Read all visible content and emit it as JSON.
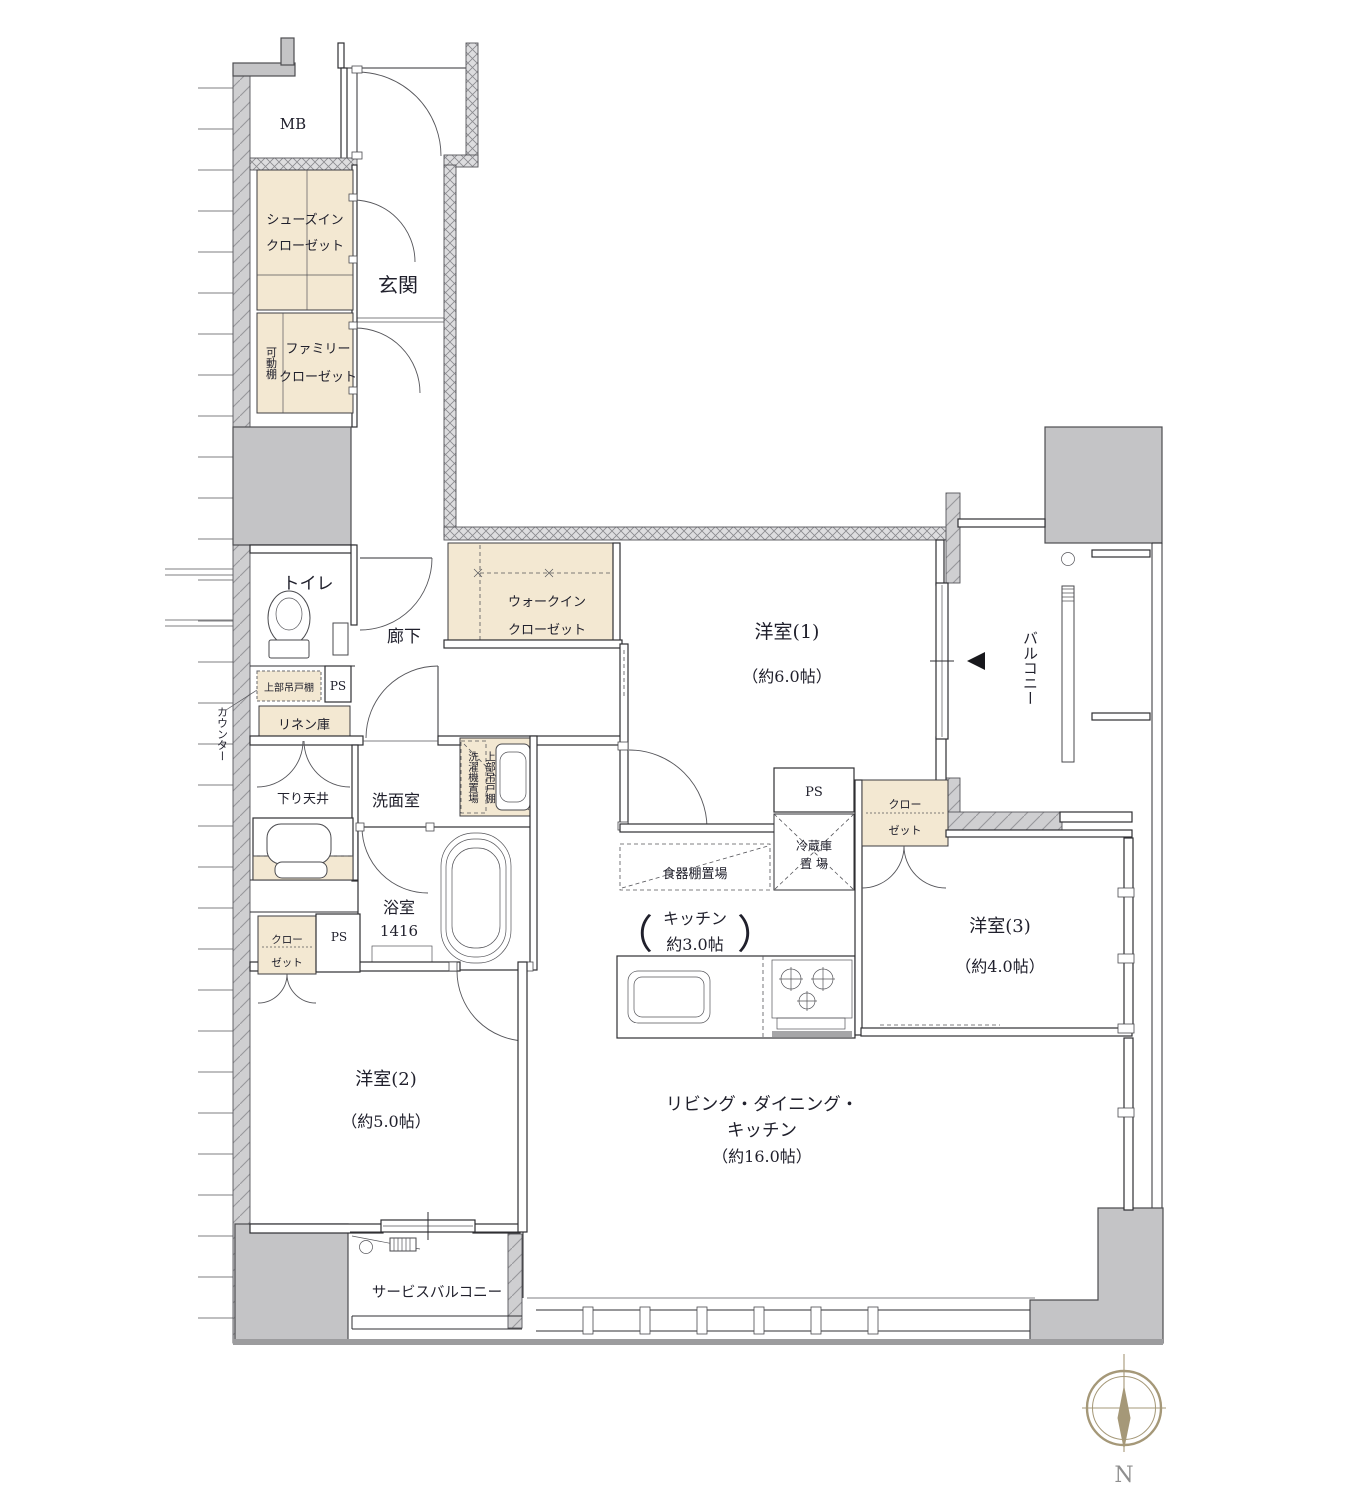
{
  "colors": {
    "wall_fill": "#c4c4c6",
    "closet_fill": "#f3e8d2",
    "line": "#2f2f33",
    "text": "#20202c",
    "compass": "#a59878"
  },
  "labels": {
    "mb": "MB",
    "entrance": "玄関",
    "hallway": "廊下",
    "toilet": "トイレ",
    "counter": "カウンター",
    "upper_cabinet_toilet": "上部吊戸棚",
    "ps_toilet": "PS",
    "linen": "リネン庫",
    "lowered_ceiling": "下り天井",
    "washroom": "洗面室",
    "washer_place": "洗濯機置場",
    "upper_cabinet_washer": "上部吊戸棚",
    "movable_shelf": "可動棚",
    "shoes_closet_l1": "シューズイン",
    "shoes_closet_l2": "クローゼット",
    "family_closet_l1": "ファミリー",
    "family_closet_l2": "クローゼット",
    "wic_l1": "ウォークイン",
    "wic_l2": "クローゼット",
    "bedroom1_name": "洋室(1)",
    "bedroom1_size": "（約6.0帖）",
    "balcony": "バルコニー",
    "bathroom_name": "浴室",
    "bathroom_size": "1416",
    "ps_kitchen": "PS",
    "fridge_l1": "冷蔵庫",
    "fridge_l2": "置 場",
    "cupboard": "食器棚置場",
    "kitchen_l1": "キッチン",
    "kitchen_l2": "約3.0帖",
    "kitchen_paren_open": "（",
    "kitchen_paren_close": "）",
    "closet3_l1": "クロー",
    "closet3_l2": "ゼット",
    "bedroom3_name": "洋室(3)",
    "bedroom3_size": "（約4.0帖）",
    "closet2_l1": "クロー",
    "closet2_l2": "ゼット",
    "ps_bedroom2": "PS",
    "bedroom2_name": "洋室(2)",
    "bedroom2_size": "（約5.0帖）",
    "ldk_l1": "リビング・ダイニング・",
    "ldk_l2": "キッチン",
    "ldk_l3": "（約16.0帖）",
    "service_balcony": "サービスバルコニー",
    "compass_north": "N"
  }
}
